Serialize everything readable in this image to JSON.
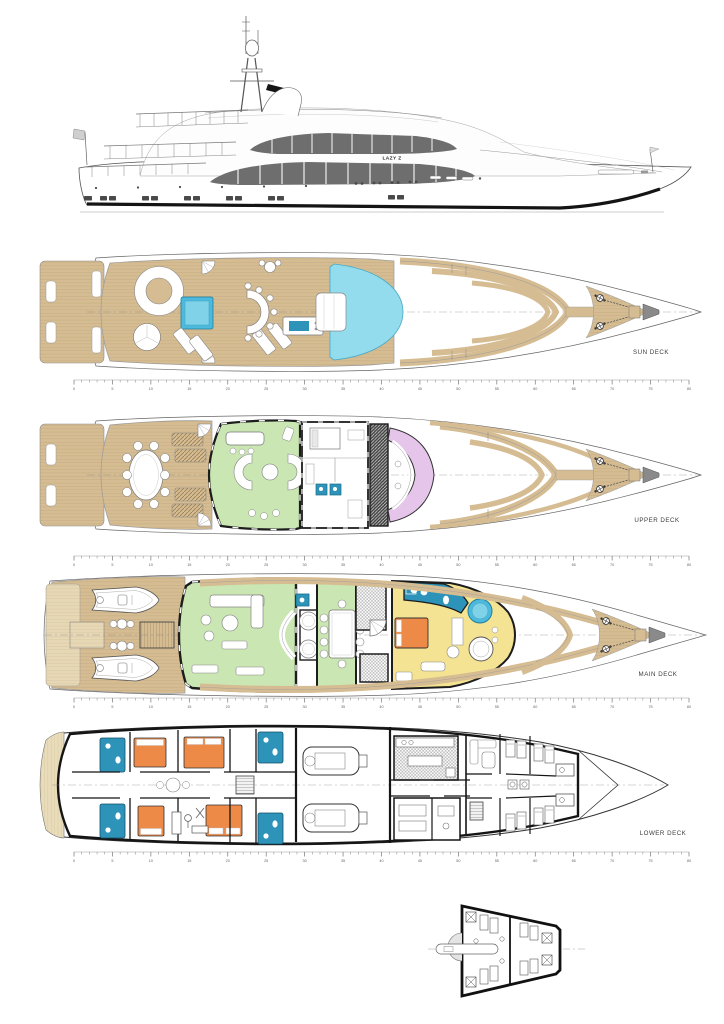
{
  "sheet": {
    "background": "#ffffff"
  },
  "yacht": {
    "name": "LAZY Z"
  },
  "decks": [
    {
      "id": "sun-deck",
      "label": "SUN DECK"
    },
    {
      "id": "upper-deck",
      "label": "UPPER DECK"
    },
    {
      "id": "main-deck",
      "label": "MAIN DECK"
    },
    {
      "id": "lower-deck",
      "label": "LOWER DECK"
    }
  ],
  "scale_ruler": {
    "min": 0,
    "max": 80,
    "minor_step": 1,
    "label_step": 5,
    "labels": [
      "0",
      "5",
      "10",
      "15",
      "20",
      "25",
      "30",
      "35",
      "40",
      "45",
      "50",
      "55",
      "60",
      "65",
      "70",
      "75",
      "80"
    ]
  },
  "colors": {
    "teak": "#d5bc92",
    "teak_light": "#e6d7b5",
    "pool_blue": "#92dcee",
    "jacuzzi_blue": "#4cb9dd",
    "lounge_green": "#cae6b2",
    "wheelhouse_lilac": "#e5c6ea",
    "suite_yellow": "#f4e392",
    "bed_orange": "#ee8a47",
    "bath_blue": "#2e93b8",
    "glass_gray": "#6e6e6e",
    "outline": "#1d1d1d"
  }
}
